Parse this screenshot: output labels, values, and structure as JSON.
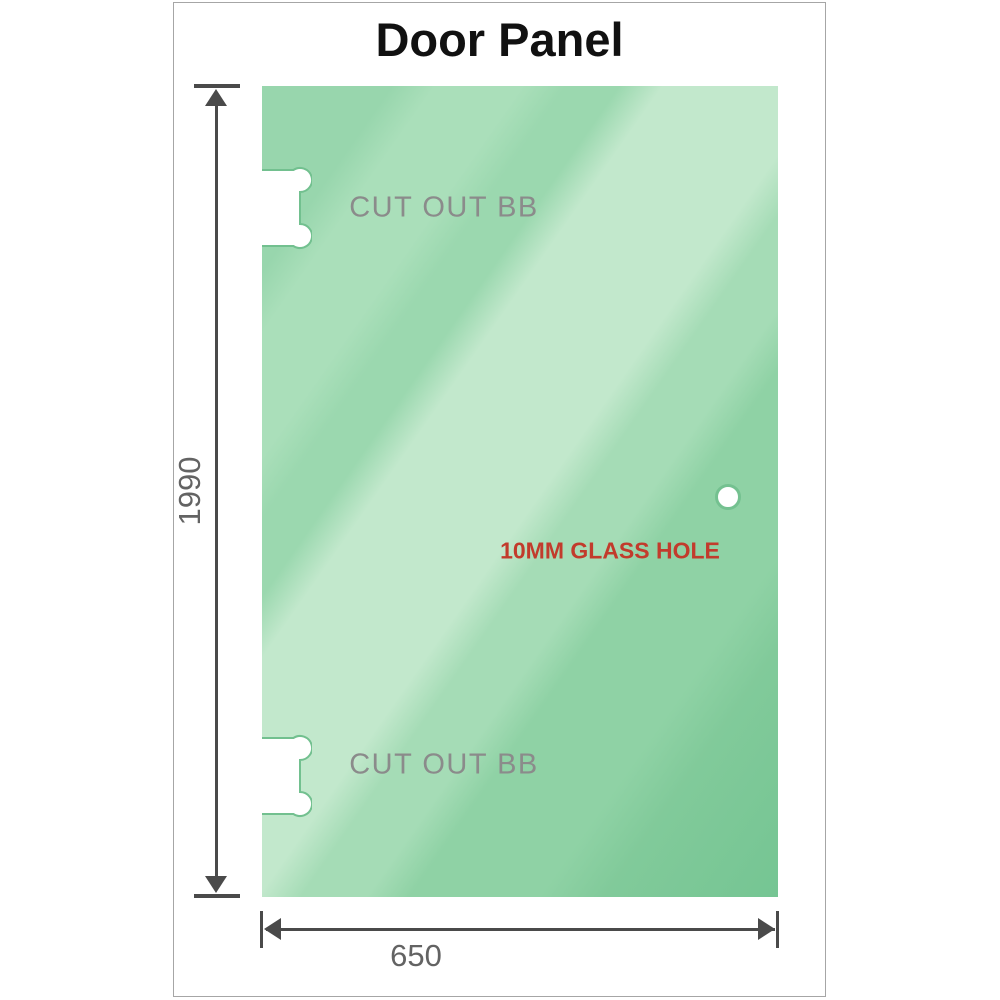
{
  "title": "Door Panel",
  "diagram": {
    "panel_name": "glass-door-panel",
    "cutouts": [
      {
        "position": "top",
        "label": "CUT OUT BB"
      },
      {
        "position": "bottom",
        "label": "CUT OUT BB"
      }
    ],
    "hole": {
      "label": "10MM GLASS HOLE"
    },
    "dimensions": {
      "height": "1990",
      "width": "650"
    }
  },
  "colors": {
    "glass_base": "#8fd2a5",
    "glass_highlight": "#c2e8cc",
    "glass_dark": "#76c593",
    "hole_ring": "#74c190",
    "dimension_line": "#4a4a4a",
    "cutout_label_text": "#8b8b8b",
    "dimension_text": "#636363",
    "hole_label_text": "#c23b2c",
    "title_text": "#111111",
    "frame_border": "#a6a6a6"
  }
}
